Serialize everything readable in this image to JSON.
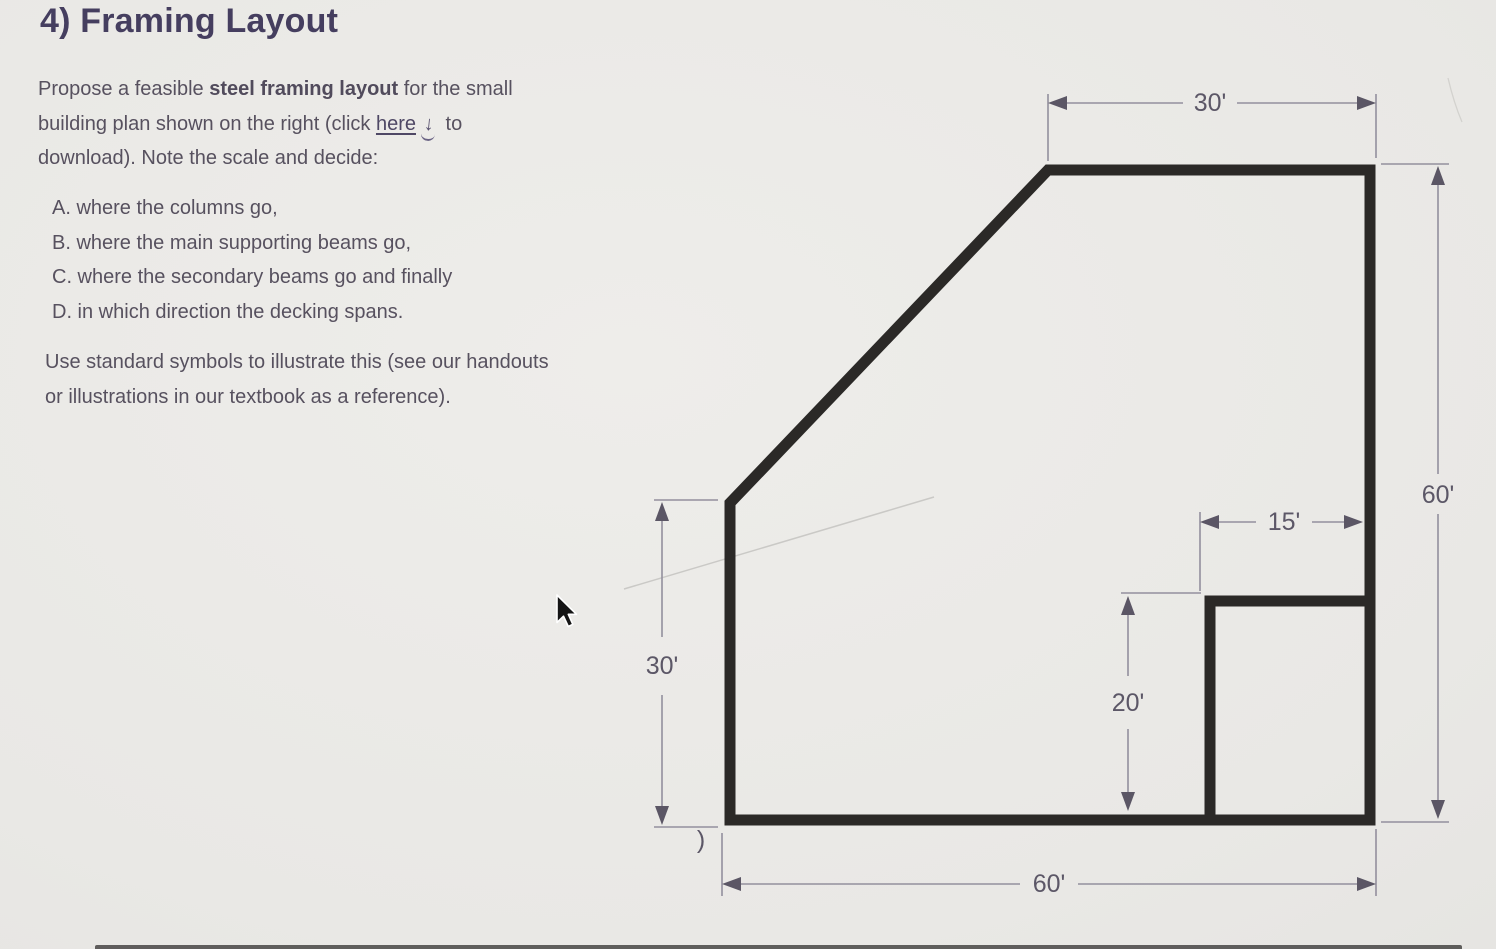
{
  "page": {
    "title": "4) Framing Layout"
  },
  "intro": {
    "l1a": "Propose a feasible ",
    "l1b": "steel framing layout",
    "l1c": " for the small",
    "l2a": "building plan shown on the right (click ",
    "link_label": "here",
    "download_icon": "↓",
    "l2b": " to",
    "l3": "download). Note the scale and decide:"
  },
  "tasks": {
    "items": [
      "A. where the columns go,",
      "B. where the main supporting beams go,",
      "C. where the secondary beams go and finally",
      "D. in which direction the decking spans."
    ]
  },
  "note": {
    "line1": "Use standard symbols to illustrate this (see our handouts",
    "line2": "or illustrations in our textbook as a reference)."
  },
  "diagram": {
    "dim_top_width": "30'",
    "dim_right_height": "60'",
    "dim_bottom_width": "60'",
    "dim_left_height": "30'",
    "dim_notch_width": "15'",
    "dim_notch_height": "20'",
    "stray_mark": ")"
  },
  "colors": {
    "title": "#453e5f",
    "body_text": "#57515f",
    "link": "#4f4865",
    "wall": "#2b2927",
    "dimension_line": "#938f9d",
    "dimension_text": "#5c5767",
    "background": "#e9e8e5"
  }
}
